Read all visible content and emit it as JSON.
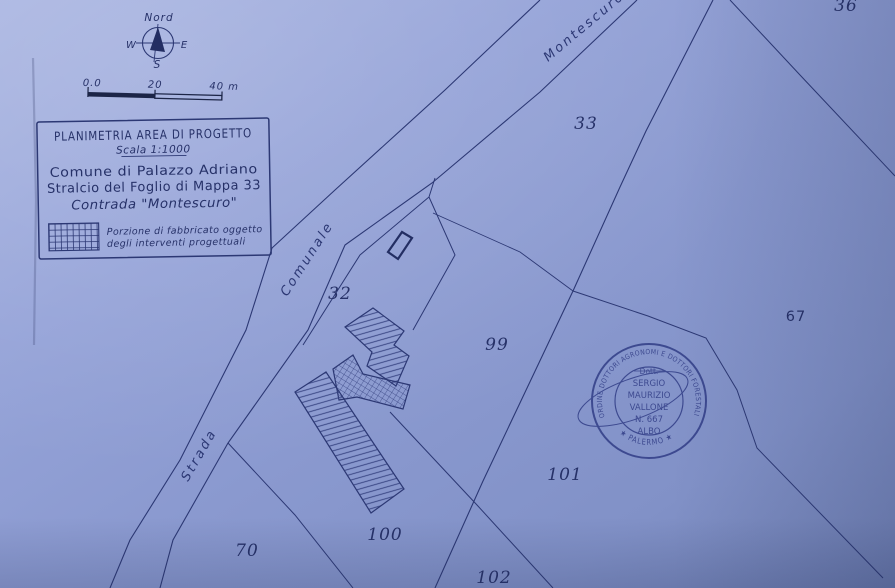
{
  "map": {
    "compass": {
      "north": "Nord",
      "west": "W",
      "east": "E",
      "south": "S"
    },
    "scale_bar": {
      "zero": "0.0",
      "twenty": "20",
      "forty": "40 m"
    },
    "title_box": {
      "title": "PLANIMETRIA AREA DI PROGETTO",
      "scale_note": "Scala 1:1000",
      "line1": "Comune di Palazzo Adriano",
      "line2": "Stralcio del Foglio di Mappa 33",
      "line3": "Contrada \"Montescuro\"",
      "legend_line1": "Porzione di fabbricato oggetto",
      "legend_line2": "degli interventi progettuali"
    },
    "road_labels": {
      "top": "Montescuro",
      "middle": "Comunale",
      "bottom": "Strada"
    },
    "parcels": [
      {
        "number": "36"
      },
      {
        "number": "33"
      },
      {
        "number": "32"
      },
      {
        "number": "99"
      },
      {
        "number": "67"
      },
      {
        "number": "101"
      },
      {
        "number": "100"
      },
      {
        "number": "70"
      },
      {
        "number": "102"
      }
    ],
    "stamp": {
      "arc_top": "ORDINE DOTTORI AGRONOMI E DOTTORI FORESTALI",
      "arc_bottom": "★ PALERMO ★",
      "center_lines": [
        "Dott.",
        "SERGIO",
        "MAURIZIO",
        "VALLONE",
        "N. 667",
        "ALBO"
      ]
    },
    "colors": {
      "paper": "#8b9ad1",
      "paper_light": "#a6b2e0",
      "paper_dark": "#7282b6",
      "ink": "#2c3874",
      "text": "#263168",
      "stamp": "#36428a",
      "scale_black": "#1c2547"
    }
  }
}
